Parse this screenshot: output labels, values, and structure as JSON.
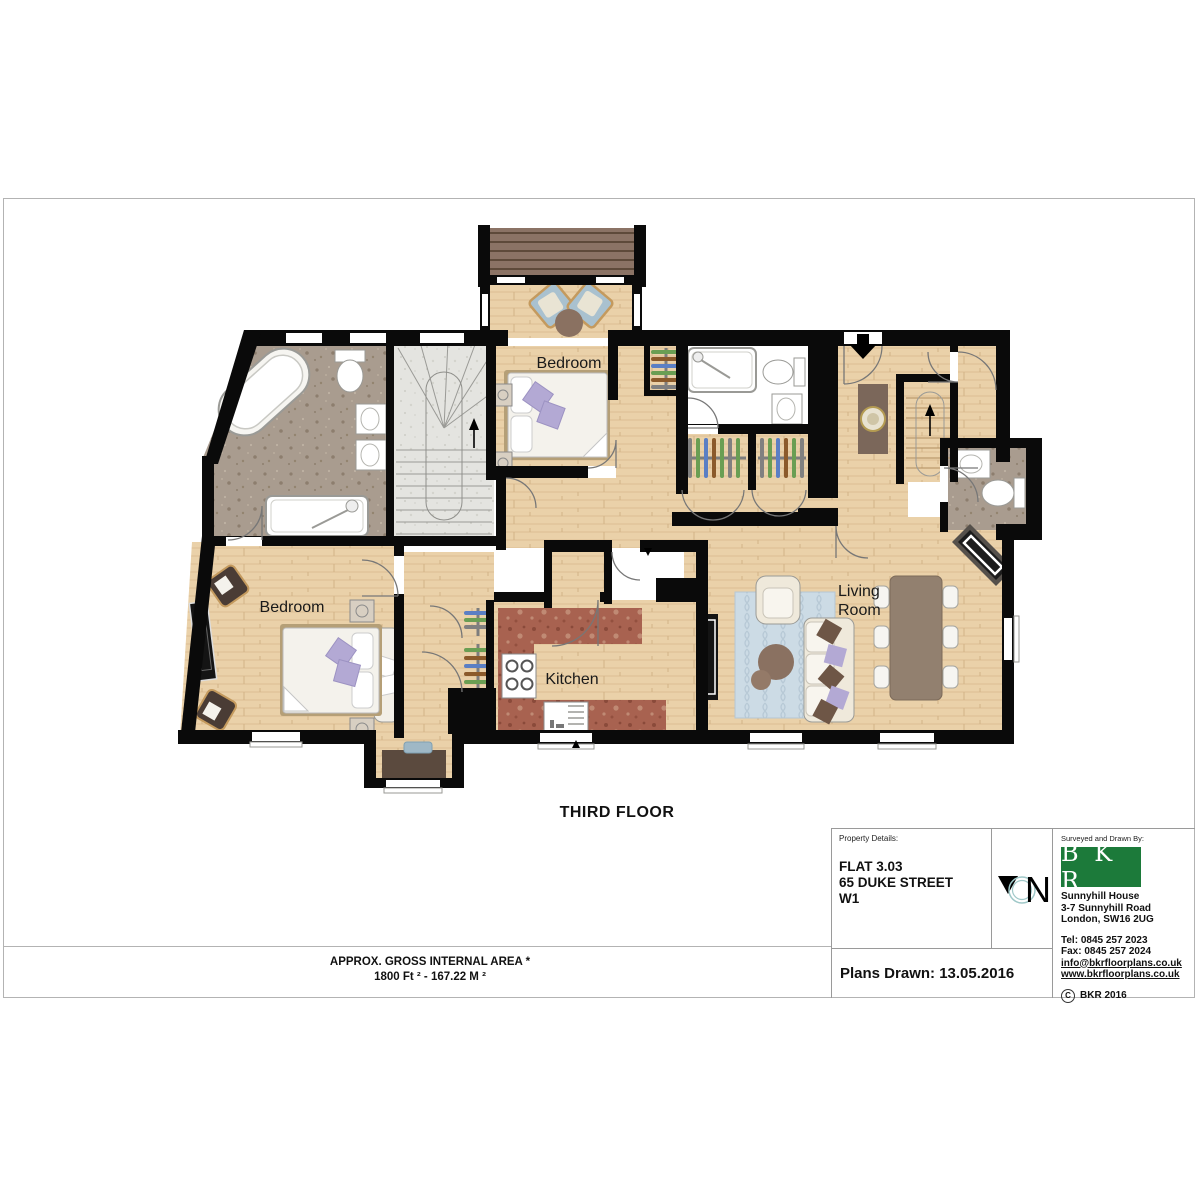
{
  "sheet": {
    "floor_label": "THIRD FLOOR",
    "area_note_line1": "APPROX. GROSS INTERNAL  AREA *",
    "area_note_line2": "1800 Ft ²  -  167.22 M ²"
  },
  "plan": {
    "labels": {
      "bedroom_top": "Bedroom",
      "bedroom_left": "Bedroom",
      "kitchen": "Kitchen",
      "living_line1": "Living",
      "living_line2": "Room"
    },
    "colors": {
      "wall": "#0a0a0a",
      "wood_floor": "#ead1a9",
      "bath_marble": "#a99c8f",
      "kitchen_counter": "#a86250",
      "stairs_floor": "#e4e4e0",
      "deck": "#8b7365",
      "rug": "#ccdbe5",
      "pillow_purple": "#b3a9d4",
      "armchair_blue": "#a9c1cf",
      "furniture_brown": "#8a7161"
    }
  },
  "title_block": {
    "property_details_label": "Property Details:",
    "property_line1": "FLAT 3.03",
    "property_line2": "65 DUKE STREET",
    "property_line3": "W1",
    "plans_drawn": "Plans Drawn: 13.05.2016",
    "compass_letter": "N",
    "surveyed_label": "Surveyed and Drawn By:",
    "logo_text": "B K R",
    "logo_color": "#1c7a3a",
    "address_line1": "Sunnyhill House",
    "address_line2": "3-7 Sunnyhill Road",
    "address_line3": "London, SW16 2UG",
    "tel": "Tel:  0845 257 2023",
    "fax": "Fax: 0845 257 2024",
    "email": "info@bkrfloorplans.co.uk",
    "website": "www.bkrfloorplans.co.uk",
    "copyright_symbol": "C",
    "copyright_text": "BKR 2016"
  }
}
